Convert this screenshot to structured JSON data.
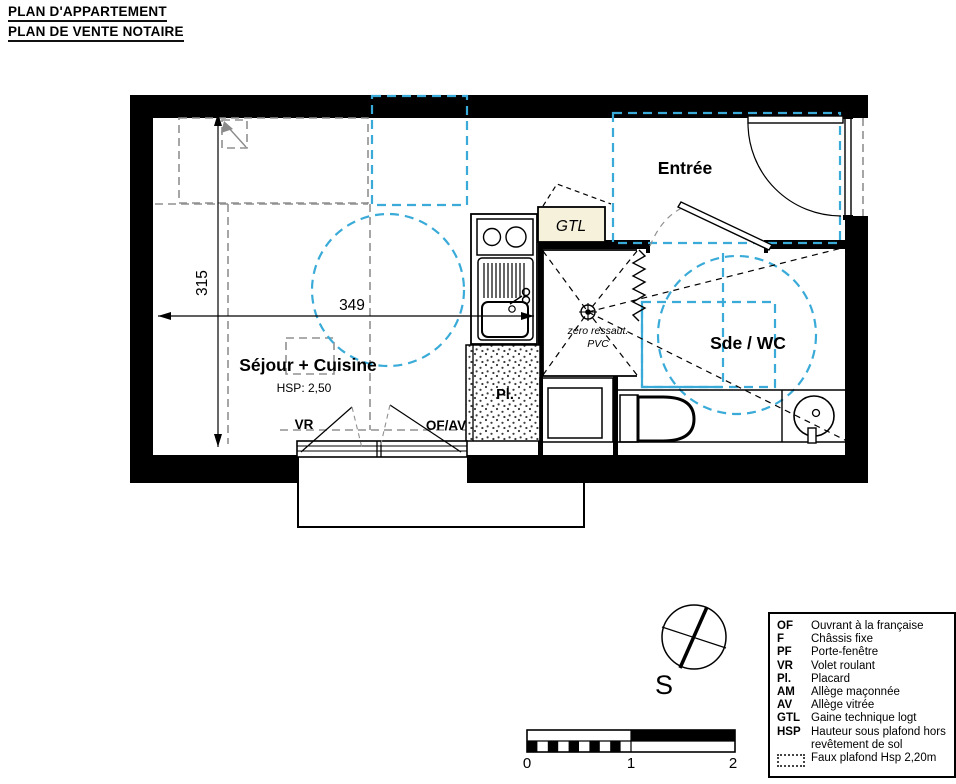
{
  "title": {
    "line1": "PLAN D'APPARTEMENT",
    "line2": "PLAN DE VENTE NOTAIRE"
  },
  "plan": {
    "rooms": {
      "sejour": {
        "name": "Séjour + Cuisine",
        "hsp": "HSP: 2,50"
      },
      "entree": {
        "name": "Entrée"
      },
      "sde_wc": {
        "name": "Sde / WC"
      },
      "gtl": {
        "name": "GTL"
      },
      "placard": {
        "name": "Pl."
      }
    },
    "labels": {
      "vr": "VR",
      "of_av": "OF/AV",
      "zero_ressaut": "zéro ressaut.",
      "pvc": "PVC"
    },
    "dimensions": {
      "width_cm": "349",
      "height_cm": "315"
    }
  },
  "compass": {
    "south": "S"
  },
  "scalebar": {
    "t0": "0",
    "t1": "1",
    "t2": "2"
  },
  "legend": {
    "entries": [
      {
        "abbr": "OF",
        "desc": "Ouvrant à la française"
      },
      {
        "abbr": "F",
        "desc": "Châssis fixe"
      },
      {
        "abbr": "PF",
        "desc": "Porte-fenêtre"
      },
      {
        "abbr": "VR",
        "desc": "Volet roulant"
      },
      {
        "abbr": "Pl.",
        "desc": "Placard"
      },
      {
        "abbr": "AM",
        "desc": "Allège maçonnée"
      },
      {
        "abbr": "AV",
        "desc": "Allège vitrée"
      },
      {
        "abbr": "GTL",
        "desc": "Gaine technique logt"
      },
      {
        "abbr": "HSP",
        "desc": "Hauteur sous plafond hors",
        "desc2": "revêtement de sol"
      },
      {
        "abbr": "",
        "desc": "Faux plafond Hsp 2,20m"
      }
    ]
  },
  "colors": {
    "accessibility": "#3aabd8",
    "faux_plafond_gray": "#909090",
    "gtl_fill": "#f5f1da",
    "wall": "#000000"
  }
}
